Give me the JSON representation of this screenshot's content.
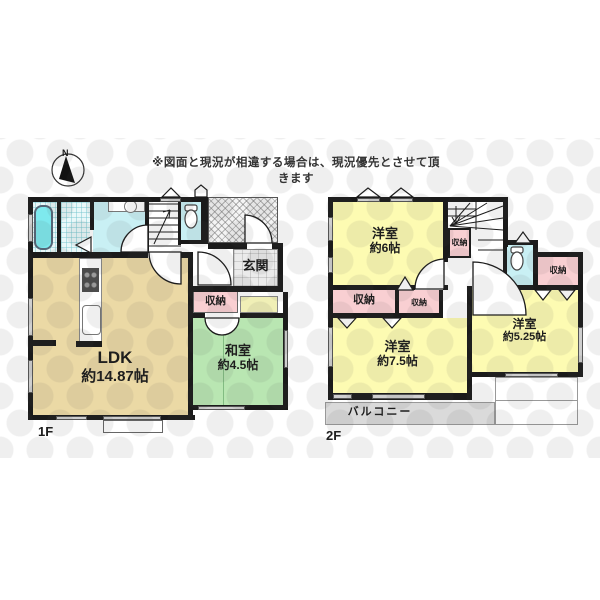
{
  "disclaimer": "※図面と現況が相違する場合は、現況優先とさせて頂きます",
  "compass": {
    "north_label": "N"
  },
  "colors": {
    "wall": "#1b1b1b",
    "room_yellow": "#fdfbb2",
    "room_green": "#b9e6b2",
    "room_pink": "#f9cfd2",
    "room_cyan": "#c9f0f4",
    "bathtub_cyan": "#7ee9ee",
    "ldk_tan": "#ebd9a5",
    "balcony_gray": "#dadada",
    "board_strip": "#f0efb6"
  },
  "floor1": {
    "label": "1F",
    "ldk": {
      "name": "LDK",
      "size": "約14.87帖"
    },
    "washitsu": {
      "name": "和室",
      "size": "約4.5帖"
    },
    "genkan": {
      "name": "玄関"
    },
    "storage": {
      "name": "収納"
    }
  },
  "floor2": {
    "label": "2F",
    "room6": {
      "name": "洋室",
      "size": "約6帖"
    },
    "room75": {
      "name": "洋室",
      "size": "約7.5帖"
    },
    "room525": {
      "name": "洋室",
      "size": "約5.25帖"
    },
    "balcony": {
      "name": "バルコニー"
    },
    "storage_left": {
      "name": "収納"
    },
    "storage_mid": {
      "name": "収納"
    },
    "storage_stair": {
      "name": "収納"
    },
    "storage_right": {
      "name": "収納"
    }
  }
}
